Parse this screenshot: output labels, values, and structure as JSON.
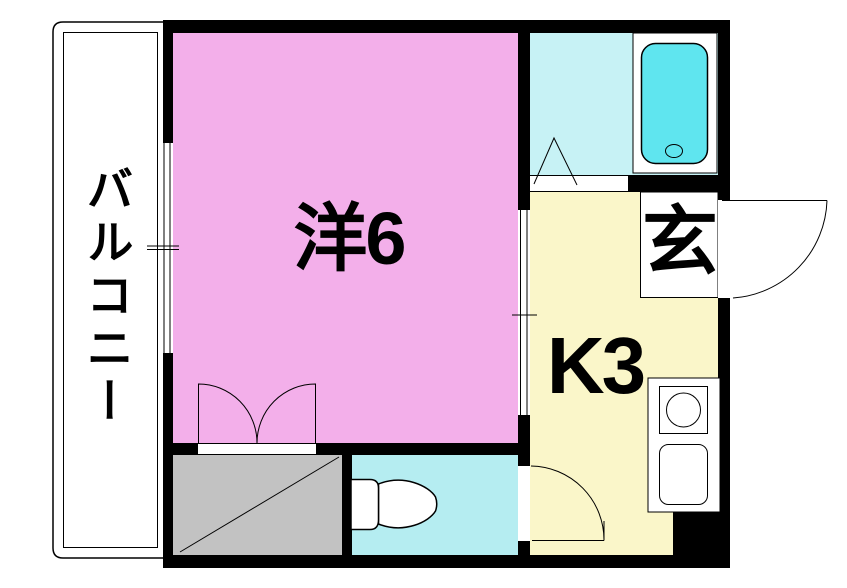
{
  "plan": {
    "rooms": {
      "balcony": {
        "label": "バルコニー"
      },
      "western_room": {
        "label": "洋6"
      },
      "kitchen": {
        "label": "K3"
      },
      "entrance": {
        "label": "玄"
      }
    },
    "colors": {
      "background": "#FFFFFF",
      "wall": "#000000",
      "line": "#000000",
      "western_room_floor": "#F3AFEA",
      "kitchen_floor": "#FAF6C9",
      "bathroom_floor": "#C7F2F5",
      "toilet_floor": "#B5EDF1",
      "bathtub": "#5FE5EF",
      "closet_floor": "#C2C2C2",
      "fixture_fill": "#FFFFFF"
    }
  }
}
